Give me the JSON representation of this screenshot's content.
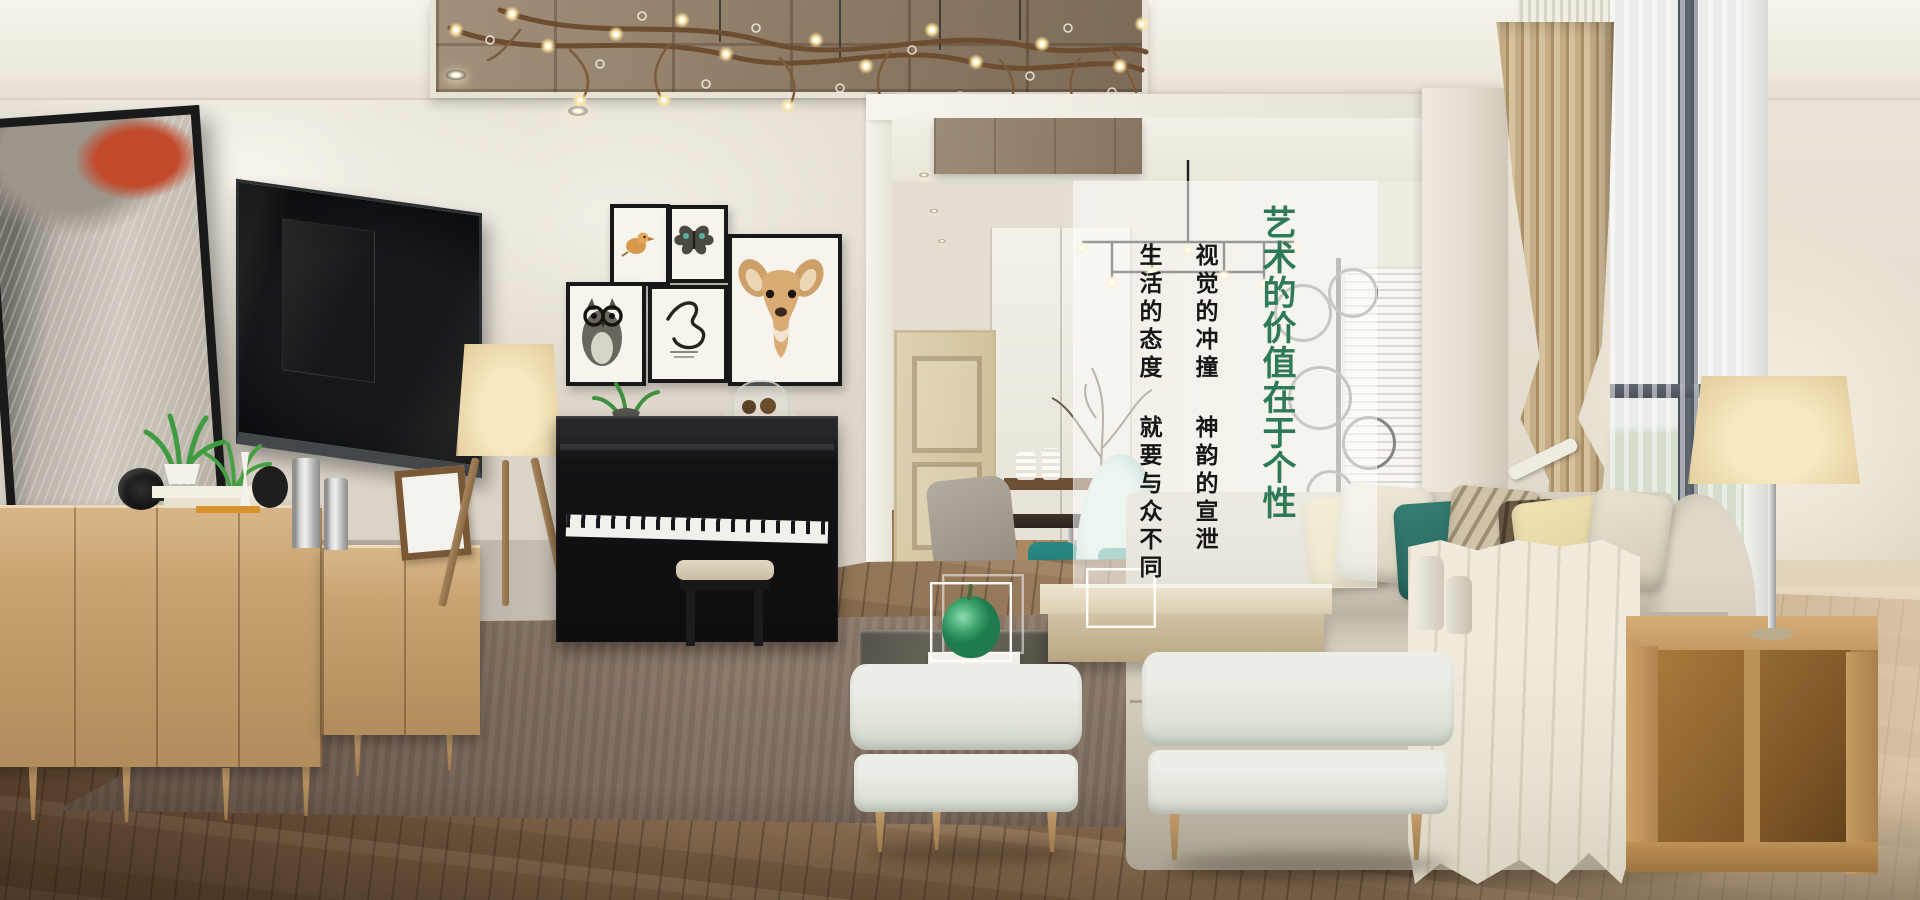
{
  "overlay": {
    "title": "艺术的价值在于个性",
    "line1": "视觉的冲撞 神韵的宣泄",
    "line2": "生活的态度 就要与众不同",
    "title_color": "#2e7a55",
    "line_color": "#161616",
    "panel_bg": "rgba(253,253,251,0.55)"
  },
  "scene": {
    "objects": [
      "branch-chandelier",
      "coffered-ceiling",
      "abstract-artwork",
      "wall-tv",
      "oak-sideboard",
      "tripod-floor-lamp",
      "gallery-frames-bird-butterfly-owl-script-deer",
      "black-upright-piano",
      "piano-bench",
      "dining-room-doorway",
      "cream-panel-door",
      "teal-egg-chair",
      "dining-chandelier",
      "beige-sofa",
      "pillows",
      "ivory-throw",
      "table-lamp",
      "wood-cube-side-table",
      "two-ottomans",
      "coffee-table",
      "green-apple-sculpture",
      "taupe-rug",
      "striped-curtain",
      "window-sheers"
    ]
  }
}
